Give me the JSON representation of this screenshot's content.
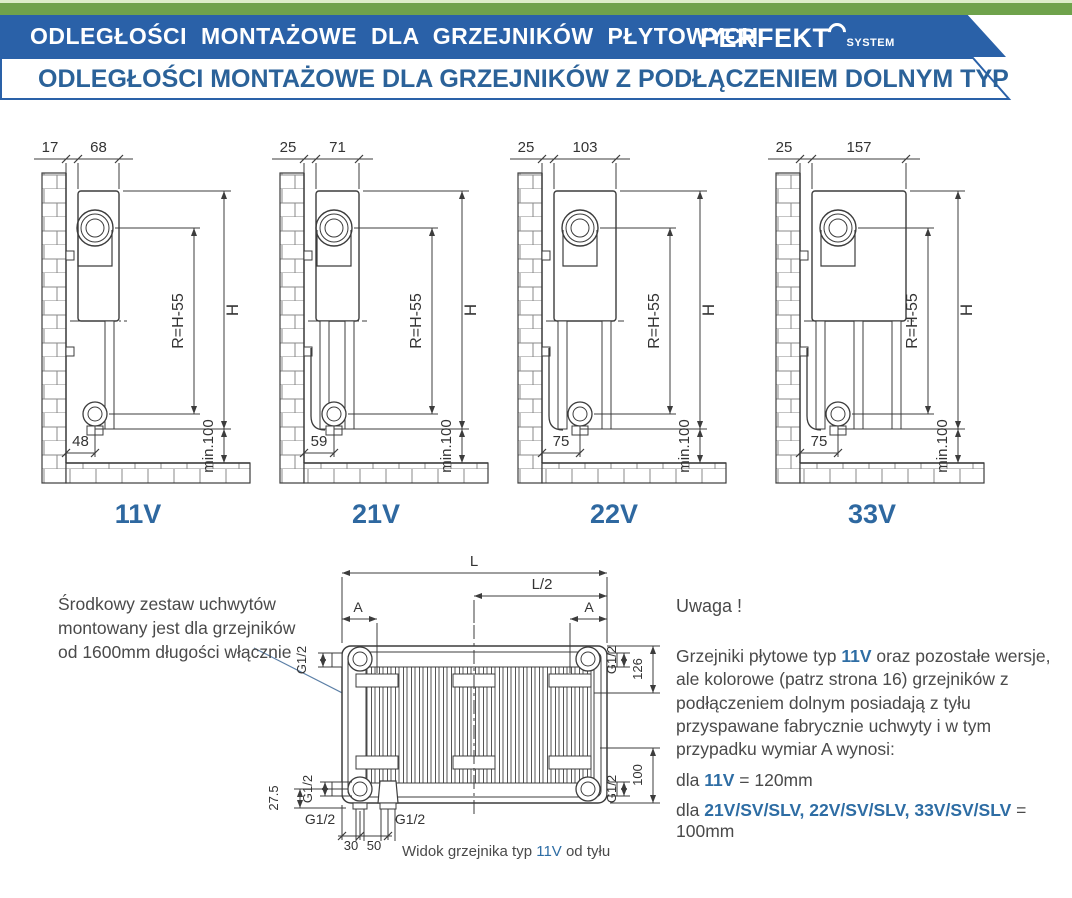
{
  "header": {
    "bar_pale_color": "#dcedc8",
    "bar_green_color": "#6fa24b",
    "banner_bg": "#2a61a8",
    "title": "ODLEGŁOŚCI MONTAŻOWE DLA GRZEJNIKÓW PŁYTOWYCH",
    "brand": "PERFEKT",
    "brand_sub": "SYSTEM",
    "subtitle": "ODLEGŁOŚCI MONTAŻOWE DLA GRZEJNIKÓW Z PODŁĄCZENIEM DOLNYM TYP V ,SV ,SLV",
    "subtitle_color": "#2b6299"
  },
  "diagrams": [
    {
      "caption": "11V",
      "top_gap": "17",
      "depth": "68",
      "radius_label": "R=H-55",
      "height_label": "H",
      "bottom_offset": "48",
      "min_label": "min.100",
      "panels": 1
    },
    {
      "caption": "21V",
      "top_gap": "25",
      "depth": "71",
      "radius_label": "R=H-55",
      "height_label": "H",
      "bottom_offset": "59",
      "min_label": "min.100",
      "panels": 2
    },
    {
      "caption": "22V",
      "top_gap": "25",
      "depth": "103",
      "radius_label": "R=H-55",
      "height_label": "H",
      "bottom_offset": "75",
      "min_label": "min.100",
      "panels": 2
    },
    {
      "caption": "33V",
      "top_gap": "25",
      "depth": "157",
      "radius_label": "R=H-55",
      "height_label": "H",
      "bottom_offset": "75",
      "min_label": "min.100",
      "panels": 3
    }
  ],
  "rear_view": {
    "labels": {
      "length": "L",
      "half_length": "L/2",
      "bracket_a_left": "A",
      "bracket_a_right": "A",
      "g12": "G1/2",
      "dim126": "126",
      "dim100": "100",
      "dim275": "27.5",
      "dim30": "30",
      "dim50": "50"
    },
    "caption_prefix": "Widok grzejnika typ ",
    "caption_type": "11V",
    "caption_suffix": " od tyłu"
  },
  "note_left": {
    "lines": [
      "Środkowy zestaw uchwytów",
      "montowany jest dla grzejników",
      "od 1600mm długości włącznie"
    ]
  },
  "note_right": {
    "heading": "Uwaga !",
    "para_1": "Grzejniki płytowe typ ",
    "para_hl": "11V",
    "para_2": " oraz pozostałe wersje, ale kolorowe (patrz strona 16) grzejników z podłączeniem dolnym posiadają z tyłu przyspawane fabrycznie uchwyty i w tym przypadku wymiar A wynosi:",
    "line1_prefix": "dla ",
    "line1_hl": "11V",
    "line1_suffix": " = 120mm",
    "line2_prefix": "dla ",
    "line2_hl": "21V/SV/SLV, 22V/SV/SLV, 33V/SV/SLV",
    "line2_suffix": " = 100mm",
    "hl_color": "#2e6da4"
  },
  "colors": {
    "line": "#3c3c3c",
    "dim_text": "#333333",
    "caption_blue": "#2e68a0",
    "leader": "#5b7fa6"
  }
}
